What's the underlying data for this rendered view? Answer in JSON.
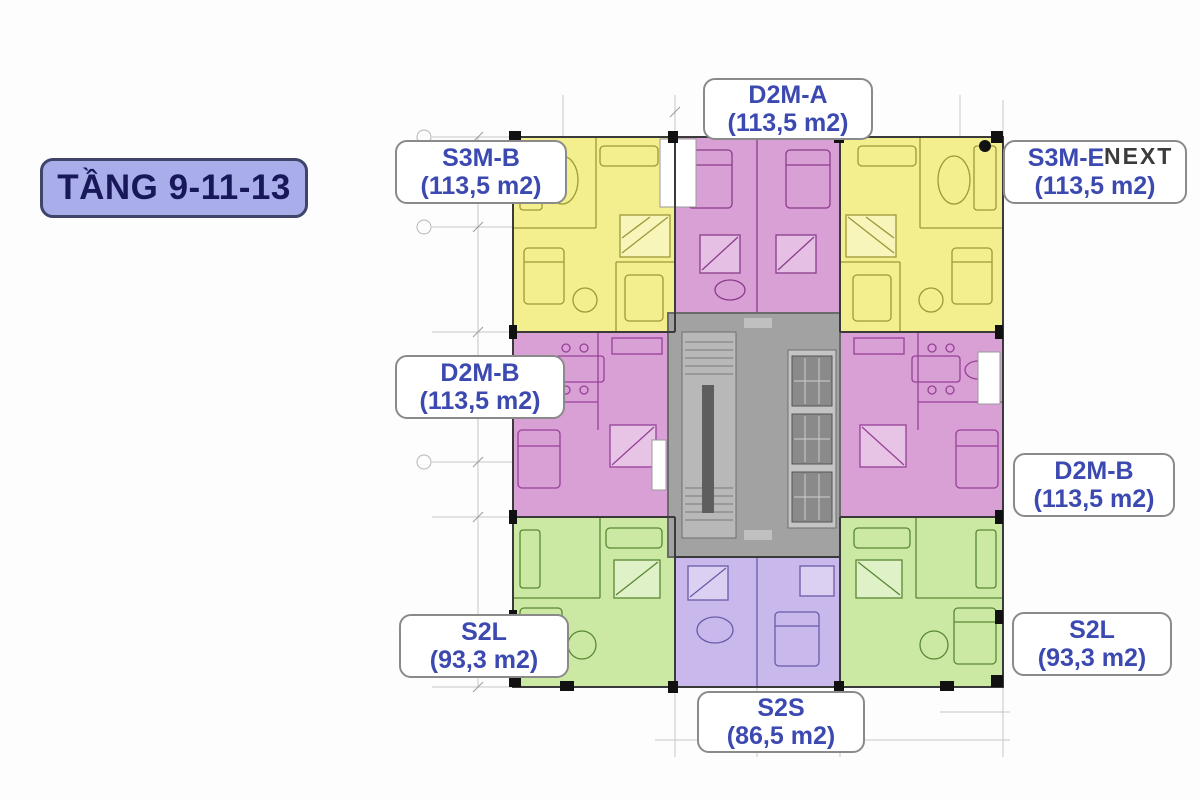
{
  "title_badge": {
    "text": "TẦNG 9-11-13"
  },
  "watermark": {
    "text": "NEXT"
  },
  "units": [
    {
      "id": "d2m-a",
      "name": "D2M-A",
      "area": "(113,5 m2)",
      "position": "top-center",
      "color": "#d9a0d6"
    },
    {
      "id": "s3m-b",
      "name": "S3M-B",
      "area": "(113,5 m2)",
      "position": "top-left",
      "color": "#f3ef8f"
    },
    {
      "id": "s3m-e",
      "name": "S3M-E",
      "area": "(113,5 m2)",
      "position": "top-right",
      "color": "#f3ef8f"
    },
    {
      "id": "d2m-b-left",
      "name": "D2M-B",
      "area": "(113,5 m2)",
      "position": "middle-left",
      "color": "#d9a0d6"
    },
    {
      "id": "d2m-b-right",
      "name": "D2M-B",
      "area": "(113,5 m2)",
      "position": "middle-right",
      "color": "#d9a0d6"
    },
    {
      "id": "s2l-left",
      "name": "S2L",
      "area": "(93,3 m2)",
      "position": "bottom-left",
      "color": "#cce9a3"
    },
    {
      "id": "s2l-right",
      "name": "S2L",
      "area": "(93,3 m2)",
      "position": "bottom-right",
      "color": "#cce9a3"
    },
    {
      "id": "s2s",
      "name": "S2S",
      "area": "(86,5 m2)",
      "position": "bottom-center",
      "color": "#c9b8ec"
    }
  ],
  "colors": {
    "unit_yellow": "#f3ef8f",
    "unit_magenta": "#d9a0d6",
    "unit_green": "#cce9a3",
    "unit_purple": "#c9b8ec",
    "core_gray": "#a2a2a2",
    "label_text_blue": "#3b49b0",
    "label_border_gray": "#8a8a8a",
    "badge_bg": "#a9aeea",
    "badge_border": "#40446b",
    "badge_text": "#17175a",
    "watermark_text": "#3b3b3b"
  }
}
